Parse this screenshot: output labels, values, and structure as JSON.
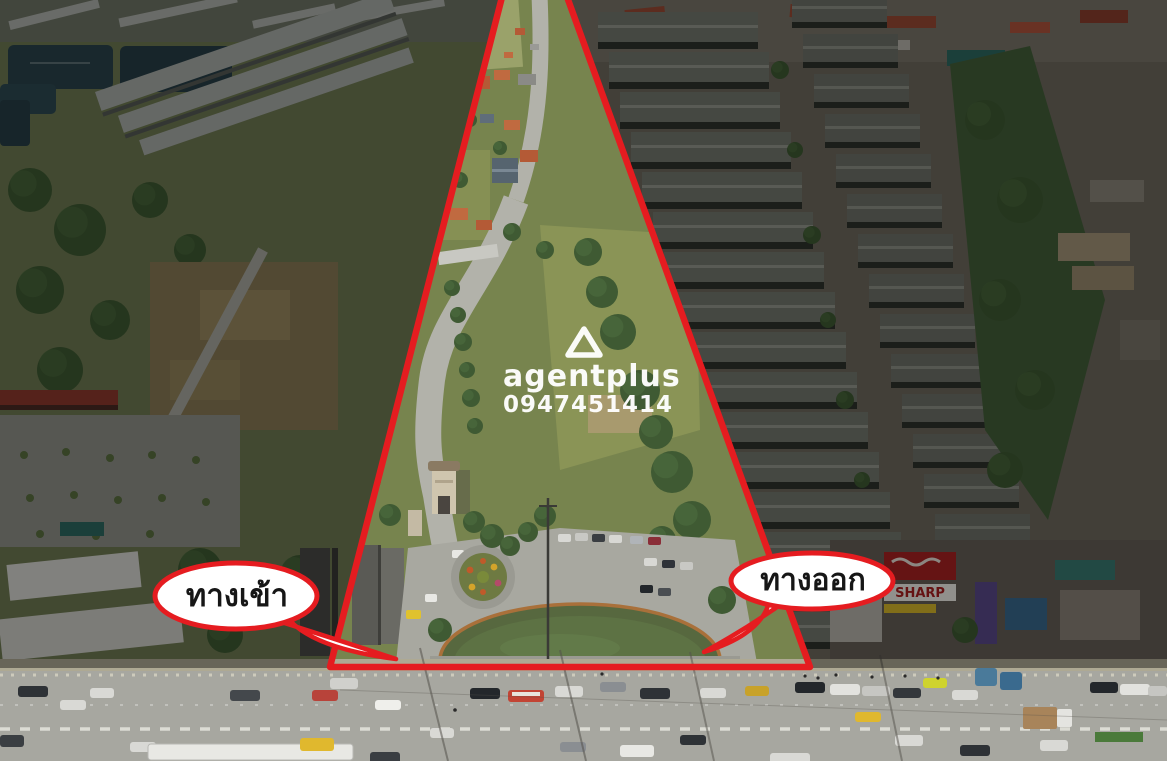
{
  "watermark": {
    "brand": "agentplus",
    "phone": "0947451414",
    "text_color": "#ffffff"
  },
  "callouts": {
    "entrance": {
      "label": "ทางเข้า"
    },
    "exit": {
      "label": "ทางออก"
    }
  },
  "boundary": {
    "shape": "triangle",
    "color": "#e51c20"
  },
  "bubble_style": {
    "fill": "#ffffff",
    "stroke": "#e51c20",
    "text_color": "#161616"
  },
  "scene": {
    "signs": {
      "sharp": "SHARP"
    }
  }
}
